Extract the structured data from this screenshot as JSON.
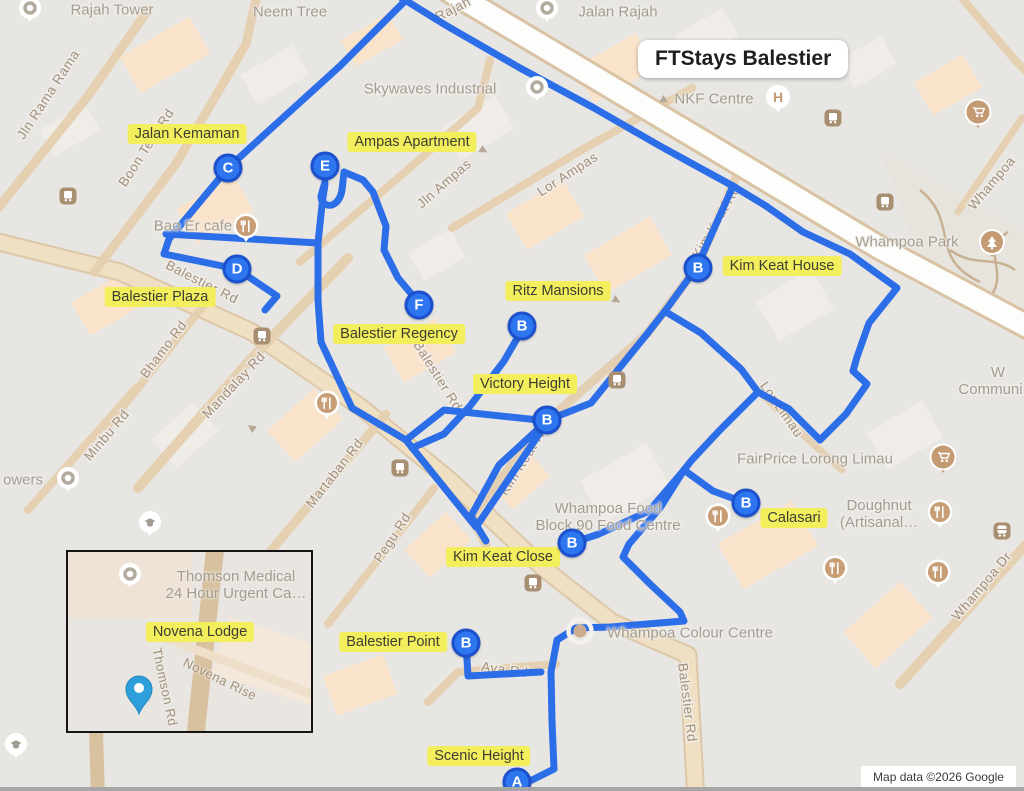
{
  "title": "FTStays Balestier",
  "attribution": "Map data ©2026 Google",
  "colors": {
    "route": "#2c6de8",
    "marker_fill": "#2d76f0",
    "marker_ring": "#1c51ce",
    "highlight": "#f2ee5c",
    "inset_pin": "#2f9fdc",
    "road_tan": "#e5d0b2",
    "map_base": "#e8e6e2"
  },
  "markers": {
    "a": "A",
    "b": "B",
    "c": "C",
    "d": "D",
    "e": "E",
    "f": "F"
  },
  "property_labels": {
    "jalan_kemaman": "Jalan Kemaman",
    "ampas_apartment": "Ampas Apartment",
    "kim_keat_house": "Kim Keat House",
    "balestier_plaza": "Balestier Plaza",
    "ritz_mansions": "Ritz Mansions",
    "balestier_regency": "Balestier Regency",
    "victory_height": "Victory Height",
    "calasari": "Calasari",
    "kim_keat_close": "Kim Keat Close",
    "balestier_point": "Balestier Point",
    "scenic_height": "Scenic Height",
    "novena_lodge": "Novena Lodge"
  },
  "map_pois": {
    "rajah_tower": "Rajah Tower",
    "neem_tree": "Neem Tree",
    "jalan_rajah": "Jalan Rajah",
    "skywaves": "Skywaves Industrial",
    "nkf": "NKF Centre",
    "whampoa_park": "Whampoa Park",
    "bao_er": "Bao Er cafe",
    "fairprice": "FairPrice Lorong Limau",
    "doughnut_l1": "Doughnut",
    "doughnut_l2": "(Artisanal…",
    "food_centre_l1": "Whampoa Food",
    "food_centre_l2": "Block 90 Food Centre",
    "colour_centre": "Whampoa Colour Centre",
    "community_l1": "W",
    "community_l2": "Communi…",
    "towers": "owers",
    "thomson_medical_l1": "Thomson Medical",
    "thomson_medical_l2": "24 Hour Urgent Ca…"
  },
  "road_labels": {
    "jln_rama_rama": "Jln Rama Rama",
    "boon_teck": "Boon Teck Rd",
    "balestier": "Balestier Rd",
    "bhamo": "Bhamo Rd",
    "minbu": "Minbu Rd",
    "mandalay": "Mandalay Rd",
    "martaban": "Martaban Rd",
    "pegu": "Pegu Rd",
    "jln_ampas": "Jln Ampas",
    "lor_ampas": "Lor Ampas",
    "kim_keat": "Kim Keat Rd",
    "lor_limau": "Lor Limau",
    "whampoa_dr": "Whampoa Dr",
    "ava": "Ava Rd",
    "whampoa": "Whampoa",
    "rajah": "Rajah",
    "novena_rise": "Novena Rise",
    "thomson_rd": "Thomson Rd"
  }
}
